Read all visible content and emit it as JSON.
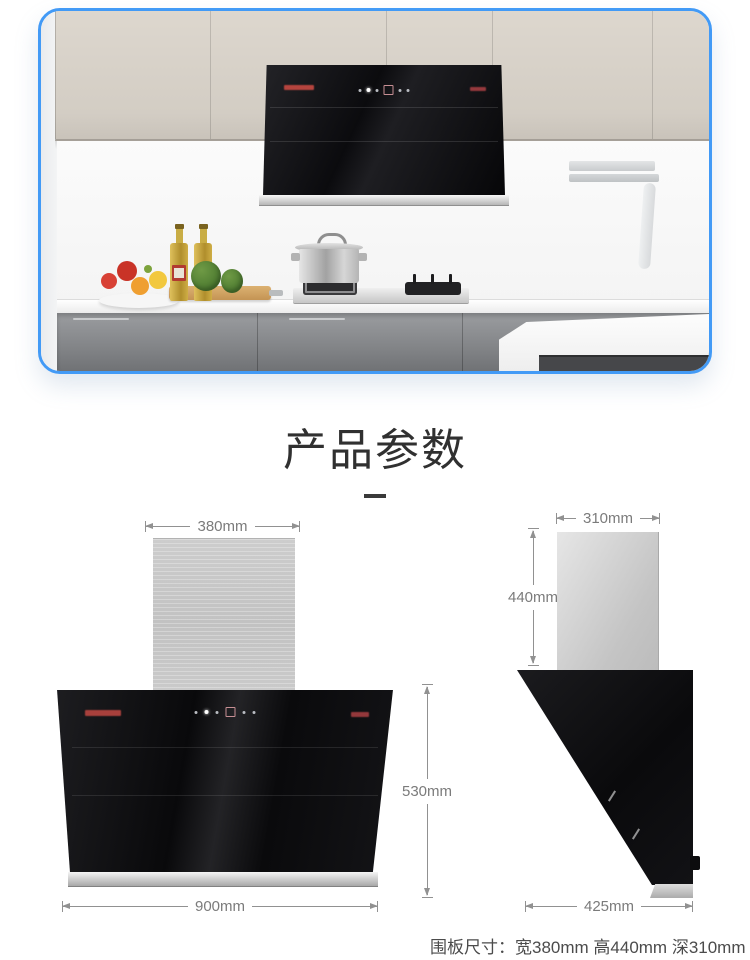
{
  "colors": {
    "photo_border": "#429af6",
    "dimension_line": "#919191",
    "dimension_text": "#7b7b7b",
    "hood_black": "#0b0b0d",
    "steel_gray": "#c7c7c7",
    "logo_red": "#a8403c"
  },
  "section": {
    "title": "产品参数"
  },
  "front_view": {
    "top_width": "380mm",
    "height": "530mm",
    "bottom_width": "900mm"
  },
  "side_view": {
    "top_width": "310mm",
    "height": "440mm",
    "bottom_width": "425mm"
  },
  "footer": {
    "panel_size_note": "围板尺寸：宽380mm 高440mm 深310mm"
  }
}
